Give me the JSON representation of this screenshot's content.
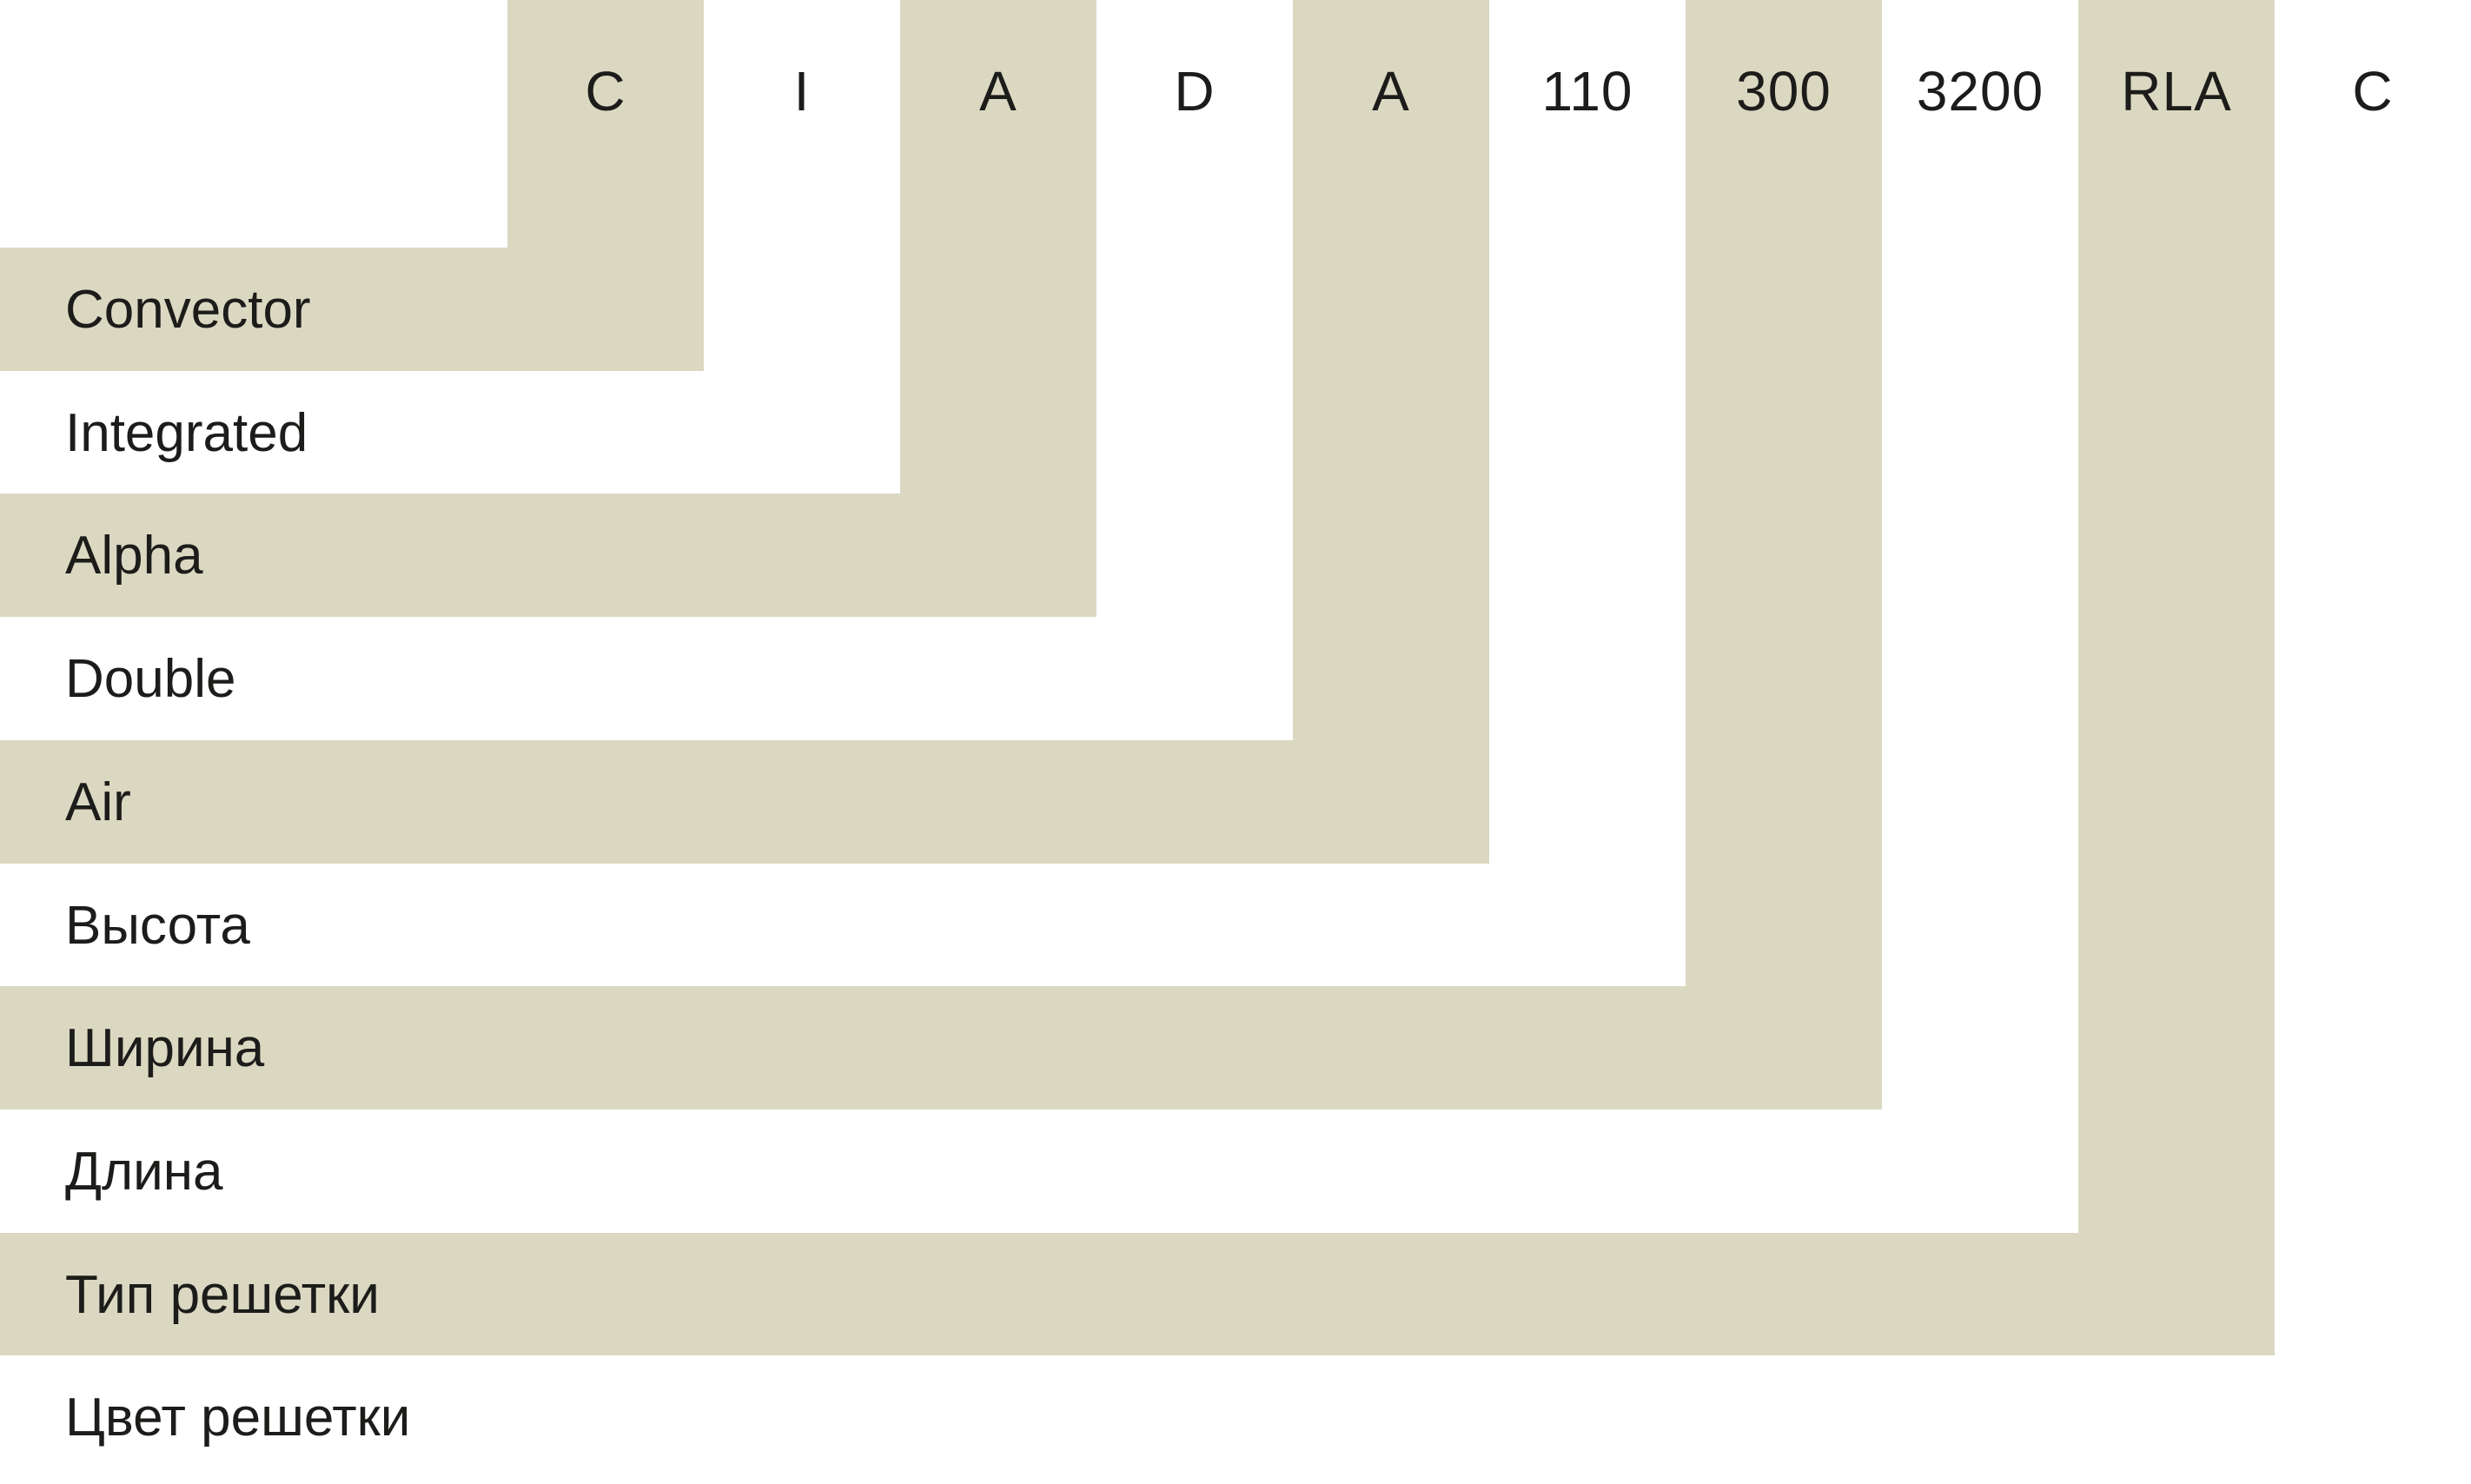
{
  "diagram": {
    "full_code": "C I A D A 110 300 3200 RLA C",
    "segments": [
      {
        "code": "C",
        "label": "Convector"
      },
      {
        "code": "I",
        "label": "Integrated"
      },
      {
        "code": "A",
        "label": "Alpha"
      },
      {
        "code": "D",
        "label": "Double"
      },
      {
        "code": "A",
        "label": "Air"
      },
      {
        "code": "110",
        "label": "Высота"
      },
      {
        "code": "300",
        "label": "Ширина"
      },
      {
        "code": "3200",
        "label": "Длина"
      },
      {
        "code": "RLA",
        "label": "Тип решетки"
      },
      {
        "code": "C",
        "label": "Цвет решетки"
      }
    ],
    "colors": {
      "band_shaded": "#dbd8c2",
      "band_light": "#fcfbf8",
      "text": "#1c1c1a",
      "background": "#ffffff"
    }
  }
}
